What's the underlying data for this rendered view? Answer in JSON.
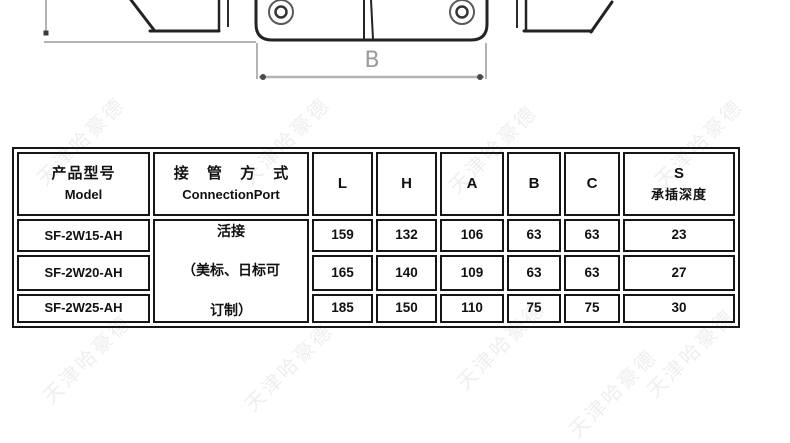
{
  "watermark": {
    "text": "天津哈豪德"
  },
  "drawing": {
    "dim_label_b": "B"
  },
  "table": {
    "header": {
      "model_cn": "产品型号",
      "model_en": "Model",
      "connection_cn": "接 管 方 式",
      "connection_en": "ConnectionPort",
      "cols": [
        "L",
        "H",
        "A",
        "B",
        "C"
      ],
      "s_top": "S",
      "s_bottom": "承插深度"
    },
    "connection_note": [
      "活接",
      "（美标、日标可",
      "订制）"
    ],
    "rows": [
      {
        "model": "SF-2W15-AH",
        "L": "159",
        "H": "132",
        "A": "106",
        "B": "63",
        "C": "63",
        "S": "23"
      },
      {
        "model": "SF-2W20-AH",
        "L": "165",
        "H": "140",
        "A": "109",
        "B": "63",
        "C": "63",
        "S": "27"
      },
      {
        "model": "SF-2W25-AH",
        "L": "185",
        "H": "150",
        "A": "110",
        "B": "75",
        "C": "75",
        "S": "30"
      }
    ]
  }
}
